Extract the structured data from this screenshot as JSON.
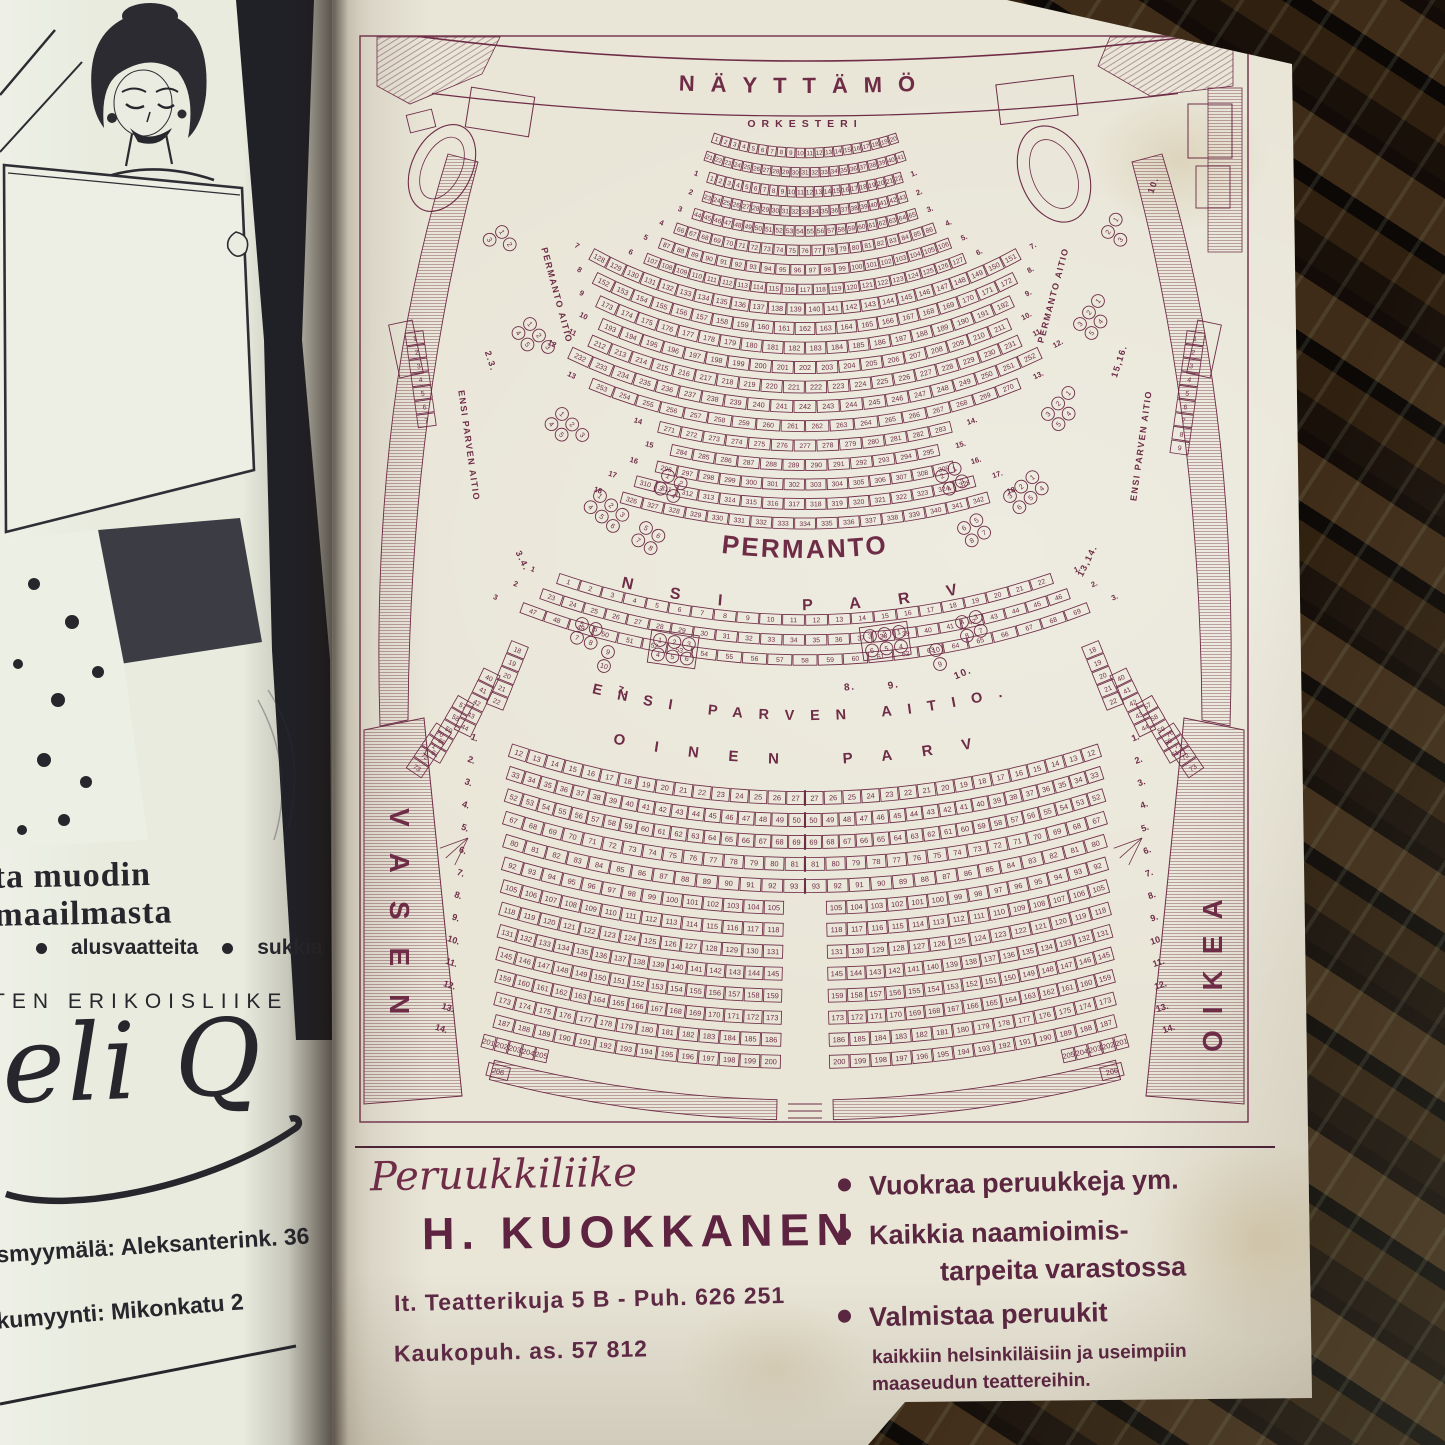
{
  "photo": {
    "wood_color": "#1a110b",
    "paper_left": "#e8ebde",
    "paper_right": "#e9e6d8",
    "ink": "#6e2c46",
    "text_dark": "#26262c"
  },
  "left_page": {
    "headline": "ta muodin maailmasta",
    "bullet_items": [
      "alusvaatteita",
      "sukkia"
    ],
    "subline": "TEN ERIKOISLIIKE",
    "logo_script": "eli Q",
    "address_line1": "smyymälä: Aleksanterink. 36",
    "address_line2": "kumyynti: Mikonkatu 2"
  },
  "seating_chart": {
    "ink": "#6e2c46",
    "stage_label": "NÄYTTÄMÖ",
    "orchestra_label": "ORKESTERI",
    "permanto_label": "PERMANTO",
    "ensi_parvi_label": "ENSI PARVI",
    "ensi_parven_aitio_label": "ENSI PARVEN AITIO.",
    "toinen_parvi_label": "TOINEN PARVI",
    "vasen_label": "VASEN",
    "oikea_label": "OIKEA",
    "permanto_aitio_label": "PERMANTO AITIO",
    "ensi_parven_aitio_side_label": "ENSI PARVEN AITIO",
    "aitio_numbers_left": [
      "2.3.",
      "3.4."
    ],
    "aitio_numbers_right": [
      "15,16.",
      "13,14.",
      "10."
    ],
    "parvi_aitio_numbers": [
      "7.",
      "8.",
      "9.",
      "10."
    ],
    "orchestra_rows": [
      {
        "start": 1,
        "end": 20,
        "span": 19
      },
      {
        "start": 21,
        "end": 41,
        "span": 19.2
      }
    ],
    "permanto_rows": [
      {
        "label": "1",
        "start": 1,
        "end": 22,
        "span": 17.5
      },
      {
        "label": "2",
        "start": 23,
        "end": 43,
        "span": 17.3
      },
      {
        "label": "3",
        "start": 44,
        "end": 65,
        "span": 18
      },
      {
        "label": "4",
        "start": 66,
        "end": 86,
        "span": 19.9
      },
      {
        "label": "5",
        "start": 87,
        "end": 106,
        "span": 21.2
      },
      {
        "label": "6",
        "start": 107,
        "end": 127,
        "span": 22.3
      },
      {
        "label": "7",
        "start": 128,
        "end": 151,
        "span": 29
      },
      {
        "label": "8",
        "start": 152,
        "end": 172,
        "span": 27.2
      },
      {
        "label": "9",
        "start": 173,
        "end": 192,
        "span": 25.6
      },
      {
        "label": "10",
        "start": 193,
        "end": 211,
        "span": 24.2
      },
      {
        "label": "11",
        "start": 212,
        "end": 231,
        "span": 24.5
      },
      {
        "label": "12",
        "start": 232,
        "end": 252,
        "span": 25.9
      },
      {
        "label": "13",
        "start": 253,
        "end": 270,
        "span": 22.6
      },
      {
        "label": "14",
        "start": 271,
        "end": 283,
        "span": 14.7
      },
      {
        "label": "15",
        "start": 284,
        "end": 295,
        "span": 13
      },
      {
        "label": "16",
        "start": 296,
        "end": 309,
        "span": 14
      },
      {
        "label": "17",
        "start": 310,
        "end": 325,
        "span": 15.5
      },
      {
        "label": "18",
        "start": 326,
        "end": 342,
        "span": 16.3
      }
    ],
    "ensi_parvi_rows": [
      {
        "label": "1",
        "start": 1,
        "end": 22,
        "span": 19.2
      },
      {
        "label": "2",
        "start": 23,
        "end": 46,
        "span": 20
      },
      {
        "label": "3",
        "start": 47,
        "end": 69,
        "span": 21
      }
    ],
    "toinen_parvi_rows": [
      {
        "label": "1",
        "end": 27,
        "count": 16,
        "span": 18.5,
        "gap": false
      },
      {
        "label": "2",
        "end": 50,
        "count": 18,
        "span": 18.2,
        "gap": false
      },
      {
        "label": "3",
        "end": 69,
        "count": 18,
        "span": 17.9,
        "gap": false
      },
      {
        "label": "4",
        "end": 81,
        "count": 15,
        "span": 17.6,
        "gap": false
      },
      {
        "label": "5",
        "end": 93,
        "count": 14,
        "span": 17.2,
        "gap": false
      },
      {
        "label": "6",
        "end": 105,
        "count": 14,
        "span": 16.9,
        "gap": true
      },
      {
        "label": "7",
        "end": 118,
        "count": 14,
        "span": 16.6,
        "gap": true
      },
      {
        "label": "8",
        "end": 131,
        "count": 14,
        "span": 16.35,
        "gap": true
      },
      {
        "label": "9",
        "end": 145,
        "count": 15,
        "span": 16.1,
        "gap": true
      },
      {
        "label": "10",
        "end": 159,
        "count": 15,
        "span": 15.85,
        "gap": true
      },
      {
        "label": "11",
        "end": 173,
        "count": 15,
        "span": 15.6,
        "gap": true
      },
      {
        "label": "12",
        "end": 186,
        "count": 14,
        "span": 15.35,
        "gap": true
      },
      {
        "label": "13",
        "end": 200,
        "count": 14,
        "span": 15.1,
        "gap": true
      }
    ],
    "toinen_corner_label": "14",
    "toinen_corner_seats": [
      201,
      202,
      203,
      204,
      205
    ],
    "toinen_corner_last": "206",
    "wall_columns_upper": {
      "left": [
        1,
        2,
        3,
        4,
        5,
        6,
        7
      ],
      "right": [
        1,
        2,
        3,
        4,
        5,
        6,
        7,
        8,
        9
      ]
    },
    "wall_columns_lower_left": [
      [
        18,
        19,
        20,
        21,
        22
      ],
      [
        40,
        41,
        42,
        43,
        44
      ],
      [
        57,
        58,
        59,
        60,
        61
      ],
      [
        70,
        71,
        72,
        73
      ]
    ],
    "wall_columns_lower_right": [
      [
        18,
        19,
        20,
        21,
        22
      ],
      [
        40,
        41,
        42,
        43,
        44
      ],
      [
        57,
        58,
        59,
        60,
        61
      ],
      [
        70,
        71,
        72,
        73
      ]
    ],
    "box_groups_left": [
      {
        "x": 152,
        "y": 206,
        "rot": 58,
        "rows": [
          [
            1,
            2
          ],
          [
            3
          ]
        ]
      },
      {
        "x": 180,
        "y": 298,
        "rot": 52,
        "rows": [
          [
            1,
            2,
            3
          ],
          [
            4,
            5
          ]
        ]
      },
      {
        "x": 212,
        "y": 388,
        "rot": 46,
        "rows": [
          [
            1,
            2,
            3
          ],
          [
            4,
            5
          ]
        ]
      },
      {
        "x": 250,
        "y": 470,
        "rot": 40,
        "rows": [
          [
            1,
            2,
            3
          ],
          [
            4,
            5,
            6
          ]
        ]
      },
      {
        "x": 318,
        "y": 450,
        "rot": 30,
        "rows": [
          [
            1,
            2
          ],
          [
            3,
            4
          ]
        ]
      },
      {
        "x": 296,
        "y": 502,
        "rot": 32,
        "rows": [
          [
            5,
            6
          ],
          [
            7,
            8
          ]
        ]
      }
    ],
    "box_groups_right": [
      {
        "x": 758,
        "y": 206,
        "rot": -58,
        "rows": [
          [
            2,
            1
          ],
          [
            3
          ]
        ]
      },
      {
        "x": 730,
        "y": 298,
        "rot": -52,
        "rows": [
          [
            3,
            2,
            1
          ],
          [
            5,
            4
          ]
        ]
      },
      {
        "x": 698,
        "y": 388,
        "rot": -46,
        "rows": [
          [
            3,
            2,
            1
          ],
          [
            5,
            4
          ]
        ]
      },
      {
        "x": 660,
        "y": 470,
        "rot": -40,
        "rows": [
          [
            3,
            2,
            1
          ],
          [
            6,
            5,
            4
          ]
        ]
      },
      {
        "x": 592,
        "y": 450,
        "rot": -30,
        "rows": [
          [
            2,
            1
          ],
          [
            4,
            3
          ]
        ]
      },
      {
        "x": 614,
        "y": 502,
        "rot": -32,
        "rows": [
          [
            6,
            5
          ],
          [
            8,
            7
          ]
        ]
      }
    ],
    "parvi_box_groups": [
      {
        "x": 232,
        "y": 598,
        "rot": 20,
        "rows": [
          [
            5,
            6
          ],
          [
            7,
            8
          ]
        ]
      },
      {
        "x": 258,
        "y": 626,
        "rot": 16,
        "rows": [
          [
            9
          ],
          [
            10
          ]
        ]
      },
      {
        "x": 310,
        "y": 614,
        "rot": 8,
        "rows": [
          [
            1,
            2,
            3
          ],
          [
            4,
            5,
            6
          ]
        ],
        "box": true
      },
      {
        "x": 520,
        "y": 610,
        "rot": -8,
        "rows": [
          [
            3,
            2,
            1
          ],
          [
            6,
            5,
            4
          ]
        ],
        "box": true
      },
      {
        "x": 612,
        "y": 596,
        "rot": -20,
        "rows": [
          [
            4,
            3
          ],
          [
            8,
            7
          ]
        ]
      },
      {
        "x": 586,
        "y": 624,
        "rot": -16,
        "rows": [
          [
            10
          ],
          [
            9
          ]
        ]
      }
    ]
  },
  "ad": {
    "shop_type_script": "Peruukkiliike",
    "shop_name": "H. KUOKKANEN",
    "address_line1": "It. Teatterikuja 5 B  -  Puh. 626 251",
    "address_line2": "Kaukopuh. as.  57 812",
    "bullets": [
      {
        "lines": [
          "Vuokraa peruukkeja ym."
        ]
      },
      {
        "lines": [
          "Kaikkia naamioimis-",
          "tarpeita varastossa"
        ]
      },
      {
        "lines": [
          "Valmistaa peruukit"
        ]
      }
    ],
    "footnote_line1": "kaikkiin helsinkiläisiin ja useimpiin",
    "footnote_line2": "maaseudun teattereihin."
  }
}
